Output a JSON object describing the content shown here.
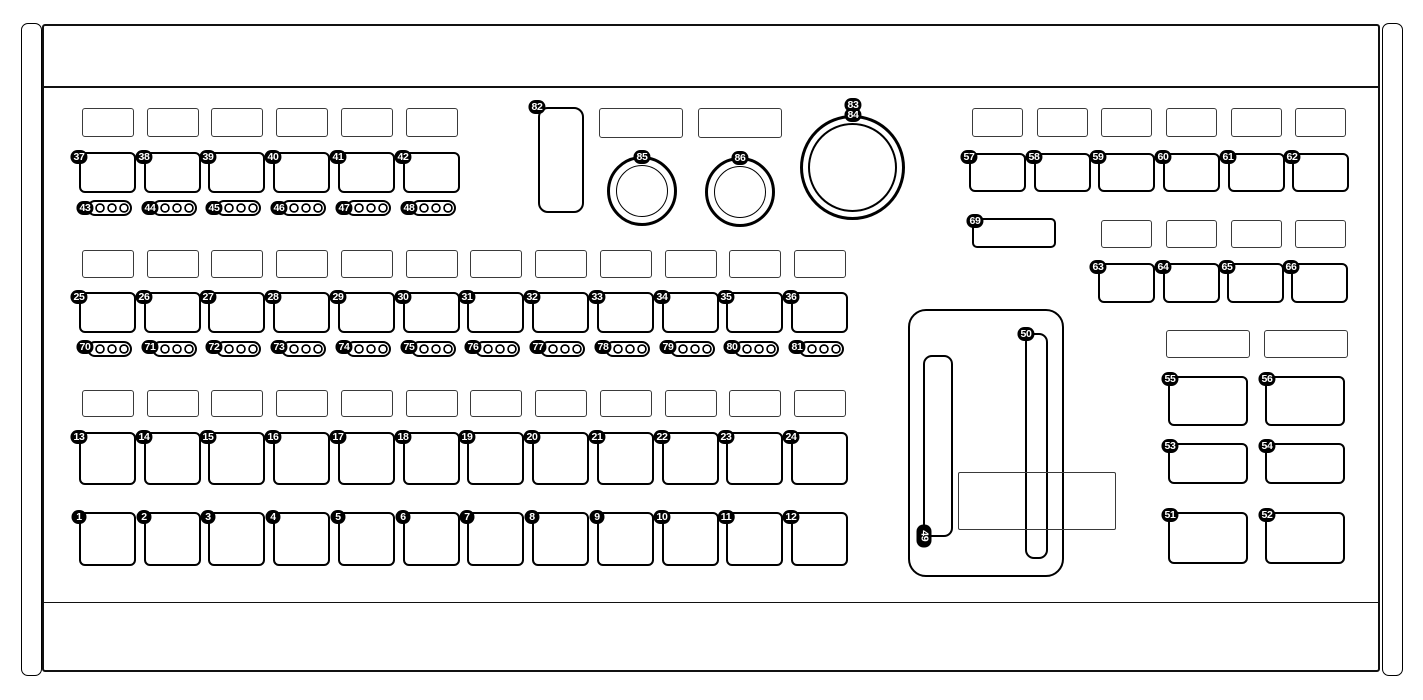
{
  "diagram": {
    "kind": "hardware-control-surface-callout-diagram",
    "colors": {
      "line": "#000000",
      "panel": "#ffffff",
      "badge_bg": "#000000",
      "badge_text": "#ffffff",
      "display_outline": "#3a3a3a"
    },
    "callouts": {
      "pads_row_1": [
        "1",
        "2",
        "3",
        "4",
        "5",
        "6",
        "7",
        "8",
        "9",
        "10",
        "11",
        "12"
      ],
      "pads_row_2": [
        "13",
        "14",
        "15",
        "16",
        "17",
        "18",
        "19",
        "20",
        "21",
        "22",
        "23",
        "24"
      ],
      "mid_buttons": [
        "25",
        "26",
        "27",
        "28",
        "29",
        "30",
        "31",
        "32",
        "33",
        "34",
        "35",
        "36"
      ],
      "top_left_buttons": [
        "37",
        "38",
        "39",
        "40",
        "41",
        "42"
      ],
      "top_left_leds": [
        "43",
        "44",
        "45",
        "46",
        "47",
        "48"
      ],
      "left_fader": "49",
      "right_fader": "50",
      "right_buttons_row3": [
        "51",
        "52"
      ],
      "right_buttons_row2": [
        "53",
        "54"
      ],
      "right_buttons_row1": [
        "55",
        "56"
      ],
      "top_right_buttons": [
        "57",
        "58",
        "59",
        "60",
        "61",
        "62"
      ],
      "top_right_sub_buttons": [
        "63",
        "64",
        "65",
        "66"
      ],
      "top_right_wide_button": "69",
      "mid_leds": [
        "70",
        "71",
        "72",
        "73",
        "74",
        "75",
        "76",
        "77",
        "78",
        "79",
        "80",
        "81"
      ],
      "touch_strip": "82",
      "big_knob": [
        "83",
        "84"
      ],
      "small_knob_left": "85",
      "small_knob_right": "86"
    }
  }
}
